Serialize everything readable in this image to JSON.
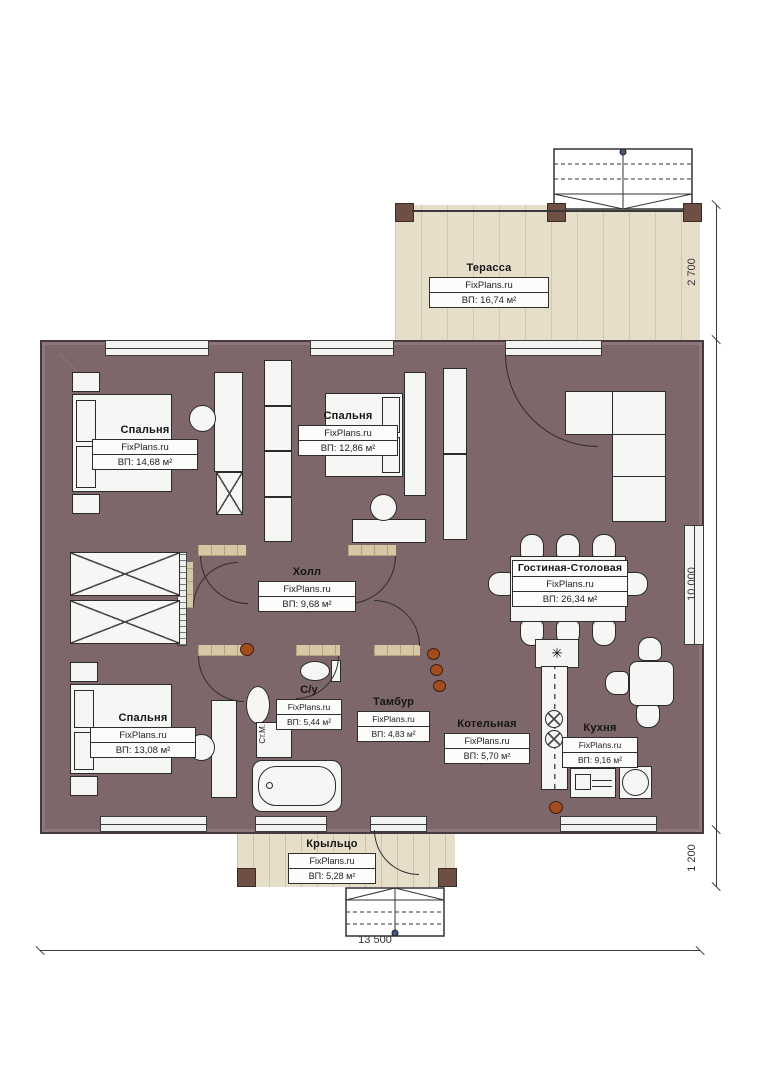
{
  "brand": "FixPlans.ru",
  "rooms": [
    {
      "name": "Терасса",
      "area": "ВП: 16,74 м²"
    },
    {
      "name": "Спальня",
      "area": "ВП: 14,68 м²"
    },
    {
      "name": "Спальня",
      "area": "ВП: 12,86 м²"
    },
    {
      "name": "Холл",
      "area": "ВП: 9,68 м²"
    },
    {
      "name": "Гостиная-Столовая",
      "area": "ВП: 26,34 м²"
    },
    {
      "name": "Спальня",
      "area": "ВП: 13,08 м²"
    },
    {
      "name": "С/у",
      "area": "ВП: 5,44 м²"
    },
    {
      "name": "Тамбур",
      "area": "ВП: 4,83 м²"
    },
    {
      "name": "Котельная",
      "area": "ВП: 5,70 м²"
    },
    {
      "name": "Кухня",
      "area": "ВП: 9,16 м²"
    },
    {
      "name": "Крыльцо",
      "area": "ВП: 5,28 м²"
    }
  ],
  "dimensions": {
    "terrace_depth": "2 700",
    "house_depth": "10 000",
    "porch_depth": "1 200",
    "house_width": "13 500"
  },
  "annotations": {
    "washing_machine": "Ст.М."
  },
  "icons": {
    "hood": "✳"
  },
  "colors": {
    "wall": "#7d676b",
    "bedroom_floor": "#8b7a58",
    "tile_floor": "#d6c7a5",
    "bath_tile": "#aacfe9",
    "boiler_tile": "#dcdcdc",
    "terrace_floor": "#e7deca"
  }
}
